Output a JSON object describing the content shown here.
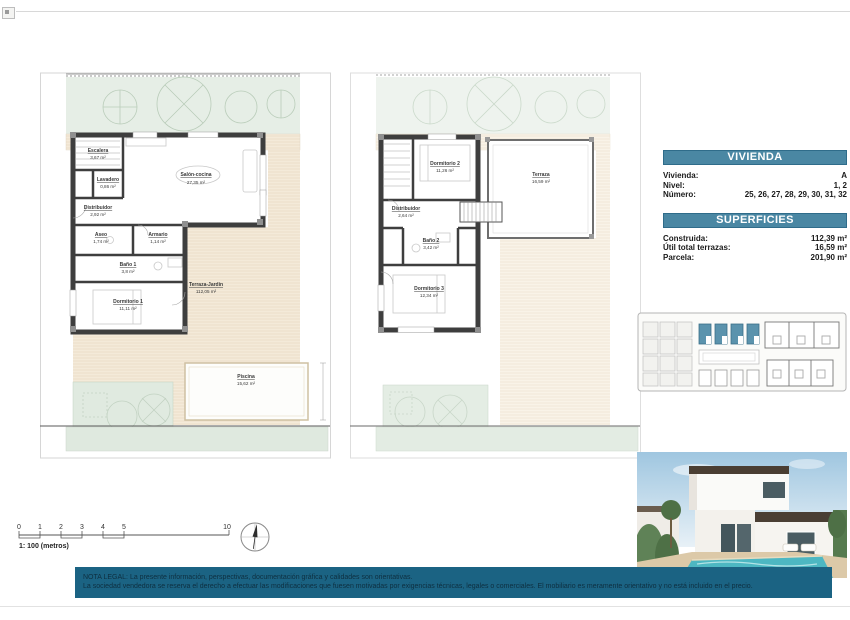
{
  "plan_left": {
    "rooms": {
      "escalera": {
        "name": "Escalera",
        "area": "3,67 m²"
      },
      "lavadero": {
        "name": "Lavadero",
        "area": "0,86 m²"
      },
      "distribuidor": {
        "name": "Distribuidor",
        "area": "2,92 m²"
      },
      "salon": {
        "name": "Salón-cocina",
        "area": "27,35 m²"
      },
      "aseo": {
        "name": "Aseo",
        "area": "1,74 m²"
      },
      "armario": {
        "name": "Armario",
        "area": "1,14 m²"
      },
      "bano1": {
        "name": "Baño 1",
        "area": "3,8 m²"
      },
      "dorm1": {
        "name": "Dormitorio 1",
        "area": "11,11 m²"
      },
      "terraza_jardin": {
        "name": "Terraza-Jardín",
        "area": "112,05 m²"
      },
      "piscina": {
        "name": "Piscina",
        "area": "15,62 m²"
      }
    }
  },
  "plan_right": {
    "rooms": {
      "dorm2": {
        "name": "Dormitorio 2",
        "area": "11,26 m²"
      },
      "terraza": {
        "name": "Terraza",
        "area": "16,59 m²"
      },
      "distribuidor": {
        "name": "Distribuidor",
        "area": "2,64 m²"
      },
      "bano2": {
        "name": "Baño 2",
        "area": "3,42 m²"
      },
      "dorm3": {
        "name": "Dormitorio 3",
        "area": "12,34 m²"
      }
    }
  },
  "info": {
    "vivienda": {
      "header": "VIVIENDA",
      "rows": [
        {
          "label": "Vivienda:",
          "value": "A"
        },
        {
          "label": "Nivel:",
          "value": "1, 2"
        },
        {
          "label": "Número:",
          "value": "25, 26, 27, 28, 29, 30, 31, 32"
        }
      ]
    },
    "superficies": {
      "header": "SUPERFICIES",
      "rows": [
        {
          "label": "Construida:",
          "value": "112,39 m²"
        },
        {
          "label": "Útil total terrazas:",
          "value": "16,59 m²"
        },
        {
          "label": "Parcela:",
          "value": "201,90 m²"
        }
      ]
    }
  },
  "scale_bar": {
    "ticks": [
      "0",
      "1",
      "2",
      "3",
      "4",
      "5",
      "10"
    ],
    "caption": "1: 100 (metros)"
  },
  "legal": {
    "line1": "NOTA LEGAL: La presente información, perspectivas, documentación gráfica y calidades son orientativas.",
    "line2": "La sociedad vendedora se reserva el derecho a efectuar las modificaciones que fuesen motivadas por exigencias técnicas, legales o comerciales. El mobiliario es meramente orientativo y no está incluido en el precio."
  },
  "colors": {
    "accent": "#4a87a3",
    "legal_band": "#1b6383",
    "wall": "#3e3e3e",
    "garden": "#e6eee6",
    "terrace_hatch": "#f4ead9",
    "site_highlight": "#5b93ad"
  }
}
